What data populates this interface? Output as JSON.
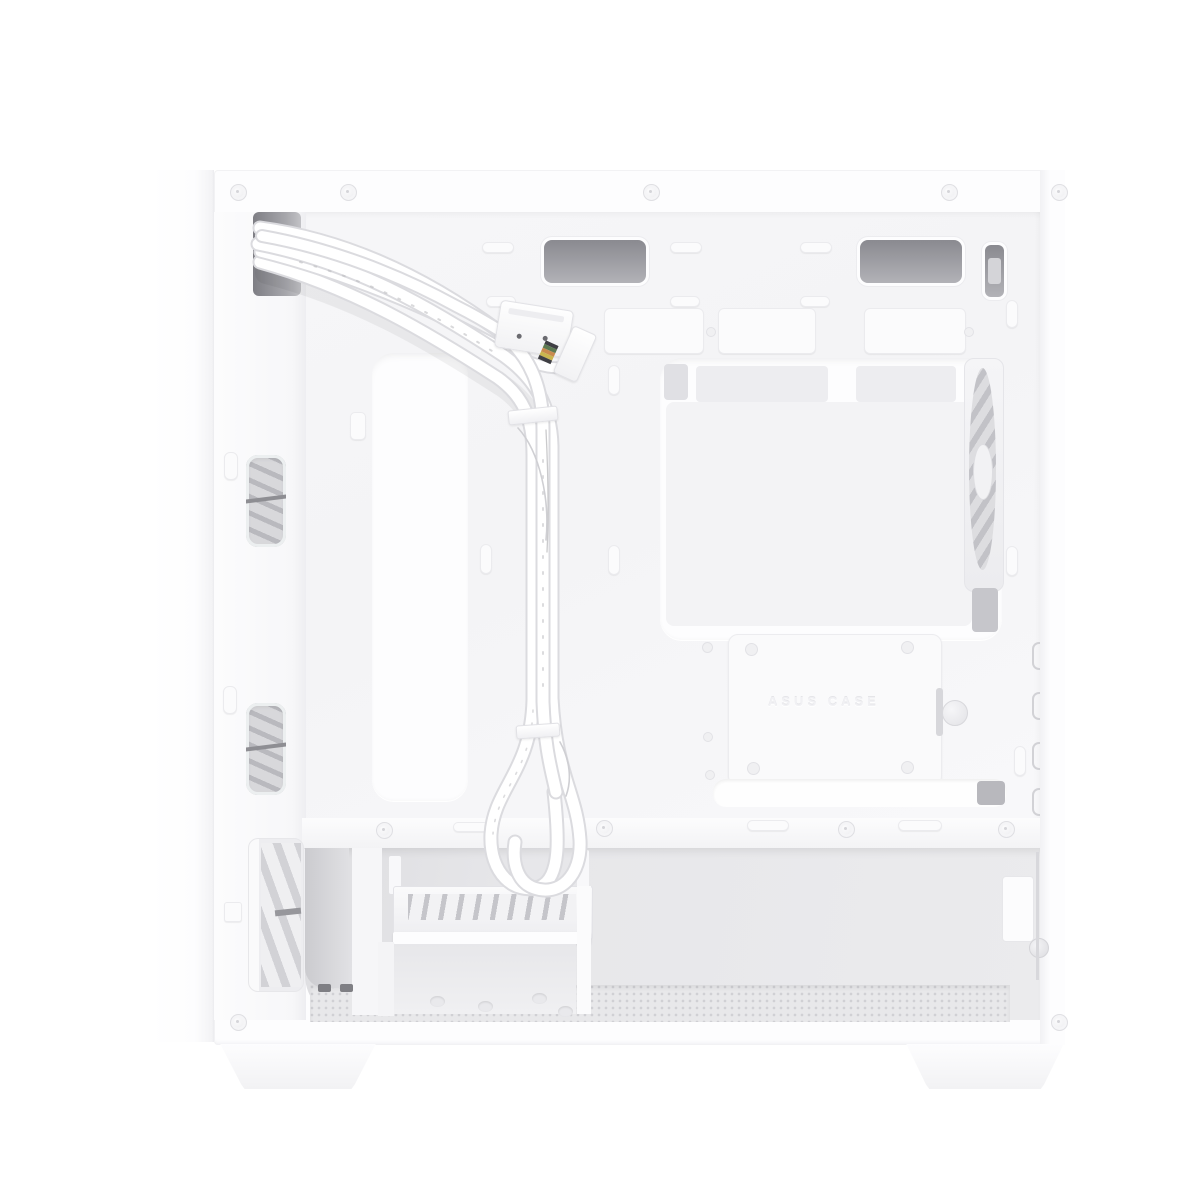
{
  "image": {
    "kind": "product-photo",
    "subject": "White micro-ATX PC tower case, side panel removed, cable-management side view",
    "orientation": "front panel on the left, rear panel with exhaust fan on the right",
    "background": "#ffffff"
  },
  "palette": {
    "bg": "#ffffff",
    "shell": "#fdfdfe",
    "shell-edge": "#ebebee",
    "tray": "#f5f5f7",
    "dark-slot-1": "#8a8a90",
    "dark-slot-2": "#b2b2b7",
    "metal": "#d9d9dc",
    "fan-gray": "#c2c2c7",
    "chamber": "#e6e6e9",
    "chamber-dark": "#d2d2d6",
    "mesh-dot": "#d0d0d4",
    "cable-edge": "#dbdbdf",
    "cable-fill": "#ffffff",
    "wire-dark": "#3f3f44",
    "wire-green": "#5d7a52",
    "wire-orange": "#c98b4e",
    "wire-yellow": "#c9b54e"
  },
  "labels": {
    "tray_embossed": "ASUS CASE"
  },
  "parts": {
    "front_panel": "Front panel (closed, left side)",
    "top_rail": "Top frame rail with rivets",
    "cable_cutout": "Cable pass-through opening at top front",
    "cable_bundle": "Flat white front-panel cable bundle with printed markings",
    "usb3_connector": "Internal USB 3.0 header connector",
    "fp_connector": "Front-panel header connector with colored leads",
    "cable_tie": "White cable tie",
    "mb_tray": "Motherboard tray, cable-management side with stamped pads and tie points",
    "routing_cutout": "Tall vertical cable-routing cutout",
    "cpu_cutout": "Large CPU-cooler backplate cutout",
    "rear_fan": "Rear 120 mm exhaust fan seen edge-on through cutout",
    "ssd_tray": "Removable 2.5-inch SSD tray with thumbscrew",
    "cable_slot": "Long horizontal cable-routing slot with grommet",
    "top_vents": "Dark ventilation slots along the top edge",
    "psu_divider": "Power-supply shroud divider rail",
    "psu_chamber": "Bottom PSU / drive chamber",
    "drive_cage": "Hard-drive cage with slotted top shelf",
    "front_fan_upper": "Front intake fan visible through upper cutout",
    "front_fan_lower_window": "Front intake fan visible through lower cutout",
    "front_fan_chamber": "Front intake fan in bottom chamber",
    "mesh_floor": "Perforated bottom floor / dust filter",
    "foot_front": "Trapezoid case foot, front",
    "foot_rear": "Trapezoid case foot, rear",
    "thumbscrew": "Knurled thumbscrew",
    "screws": "Rivet and screw heads along the frame"
  },
  "counts": {
    "top_rail_screws": 5,
    "bottom_rail_screws": 2,
    "divider_screws": 4,
    "ssd_tray_screw_holes": 4,
    "rear_bracket_slots": 4
  }
}
